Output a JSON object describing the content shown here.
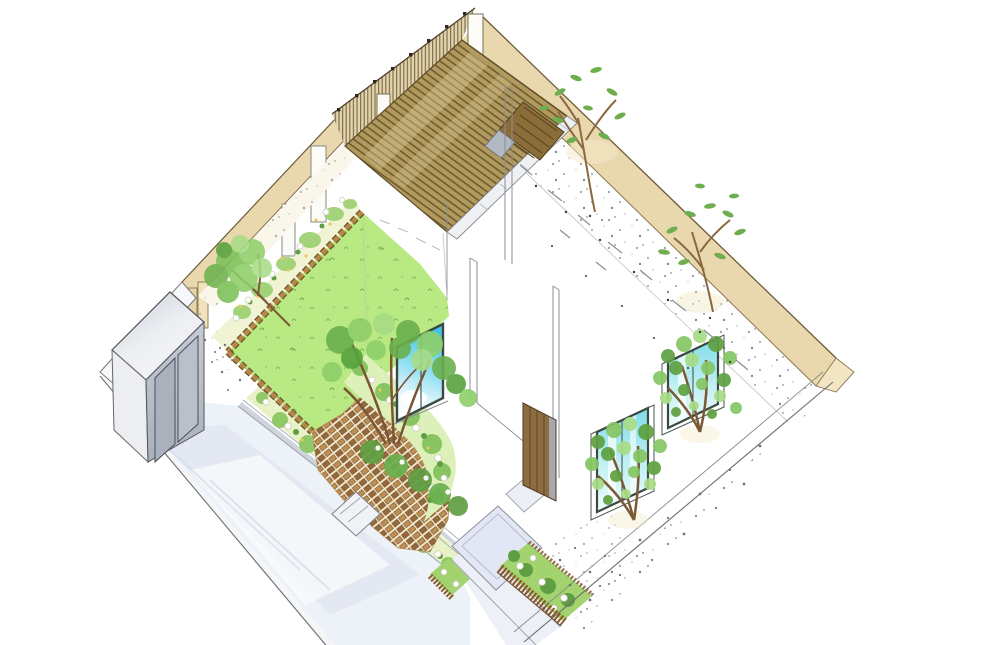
{
  "scene": {
    "type": "hand-drawn axonometric landscape plan sketch",
    "description": "Hand-drawn axonometric marker sketch of a residential courtyard garden: wooden deck with slatted pergola fence at the rear corner, bright green lawn, curved brick-paved patio with flower beds, perimeter garden walls, gravel paths with trees, driveway, entrance walk, hedge planters and a grey storage shed",
    "background": "#ffffff"
  },
  "palette": {
    "wall_tan": "#e9d7ad",
    "wall_edge": "#7d6b45",
    "wall_end": "#f1e5c3",
    "deck_wood": "#b19a5e",
    "deck_slat": "#5f4a22",
    "fence_wood": "#e3d4ab",
    "lawn_green": "#b9e982",
    "grass_mark": "#6fae49",
    "bed_base": "#f0f4d4",
    "bed_leaf": "#9ad06e",
    "bed_leaf_dark": "#5f9e42",
    "flower_white": "#ffffff",
    "flower_yellow": "#e9cb5e",
    "wood_edging": "#b28747",
    "brick_base": "#f2e4c4",
    "brick_light": "#bb8a50",
    "brick_dark": "#8f6236",
    "driveway": "#edf1f8",
    "entrance": "#e3e7f5",
    "walk": "#eef0f7",
    "hedge": "#a3d36f",
    "stake_wood": "#8a5c2e",
    "shed_grey": "#c3c9d2",
    "glass_cyan": "#3fc4e8",
    "door_wood": "#8d6c42",
    "trunk_brown": "#7a5a36",
    "foliage": "#6fb24e",
    "foliage_light": "#a8dc86",
    "foliage_dark": "#56a23e",
    "ink": "#555555"
  },
  "elements": [
    {
      "name": "perimeter-wall-right",
      "label": "tan garden wall (north-east side)"
    },
    {
      "name": "perimeter-wall-left",
      "label": "tan garden wall (north-west side)"
    },
    {
      "name": "slat-fence",
      "label": "vertical wood slat screen fence"
    },
    {
      "name": "wood-deck",
      "label": "wood deck terrace with plank decking"
    },
    {
      "name": "deck-steps",
      "label": "wooden deck steps"
    },
    {
      "name": "lawn",
      "label": "lawn"
    },
    {
      "name": "flower-beds",
      "label": "perennial flower beds with white blooms"
    },
    {
      "name": "brick-patio",
      "label": "curved brick-paved garden patio"
    },
    {
      "name": "driveway",
      "label": "concrete driveway / parking"
    },
    {
      "name": "entrance-landing",
      "label": "entrance landing and walk"
    },
    {
      "name": "hedge-planters",
      "label": "low hedge planters with timber stake edging"
    },
    {
      "name": "storage-shed",
      "label": "grey storage shed"
    },
    {
      "name": "house",
      "label": "white house volume with windows and wooden door"
    },
    {
      "name": "garden-trees",
      "label": "garden trees"
    },
    {
      "name": "gravel",
      "label": "stippled gravel ground cover"
    }
  ]
}
